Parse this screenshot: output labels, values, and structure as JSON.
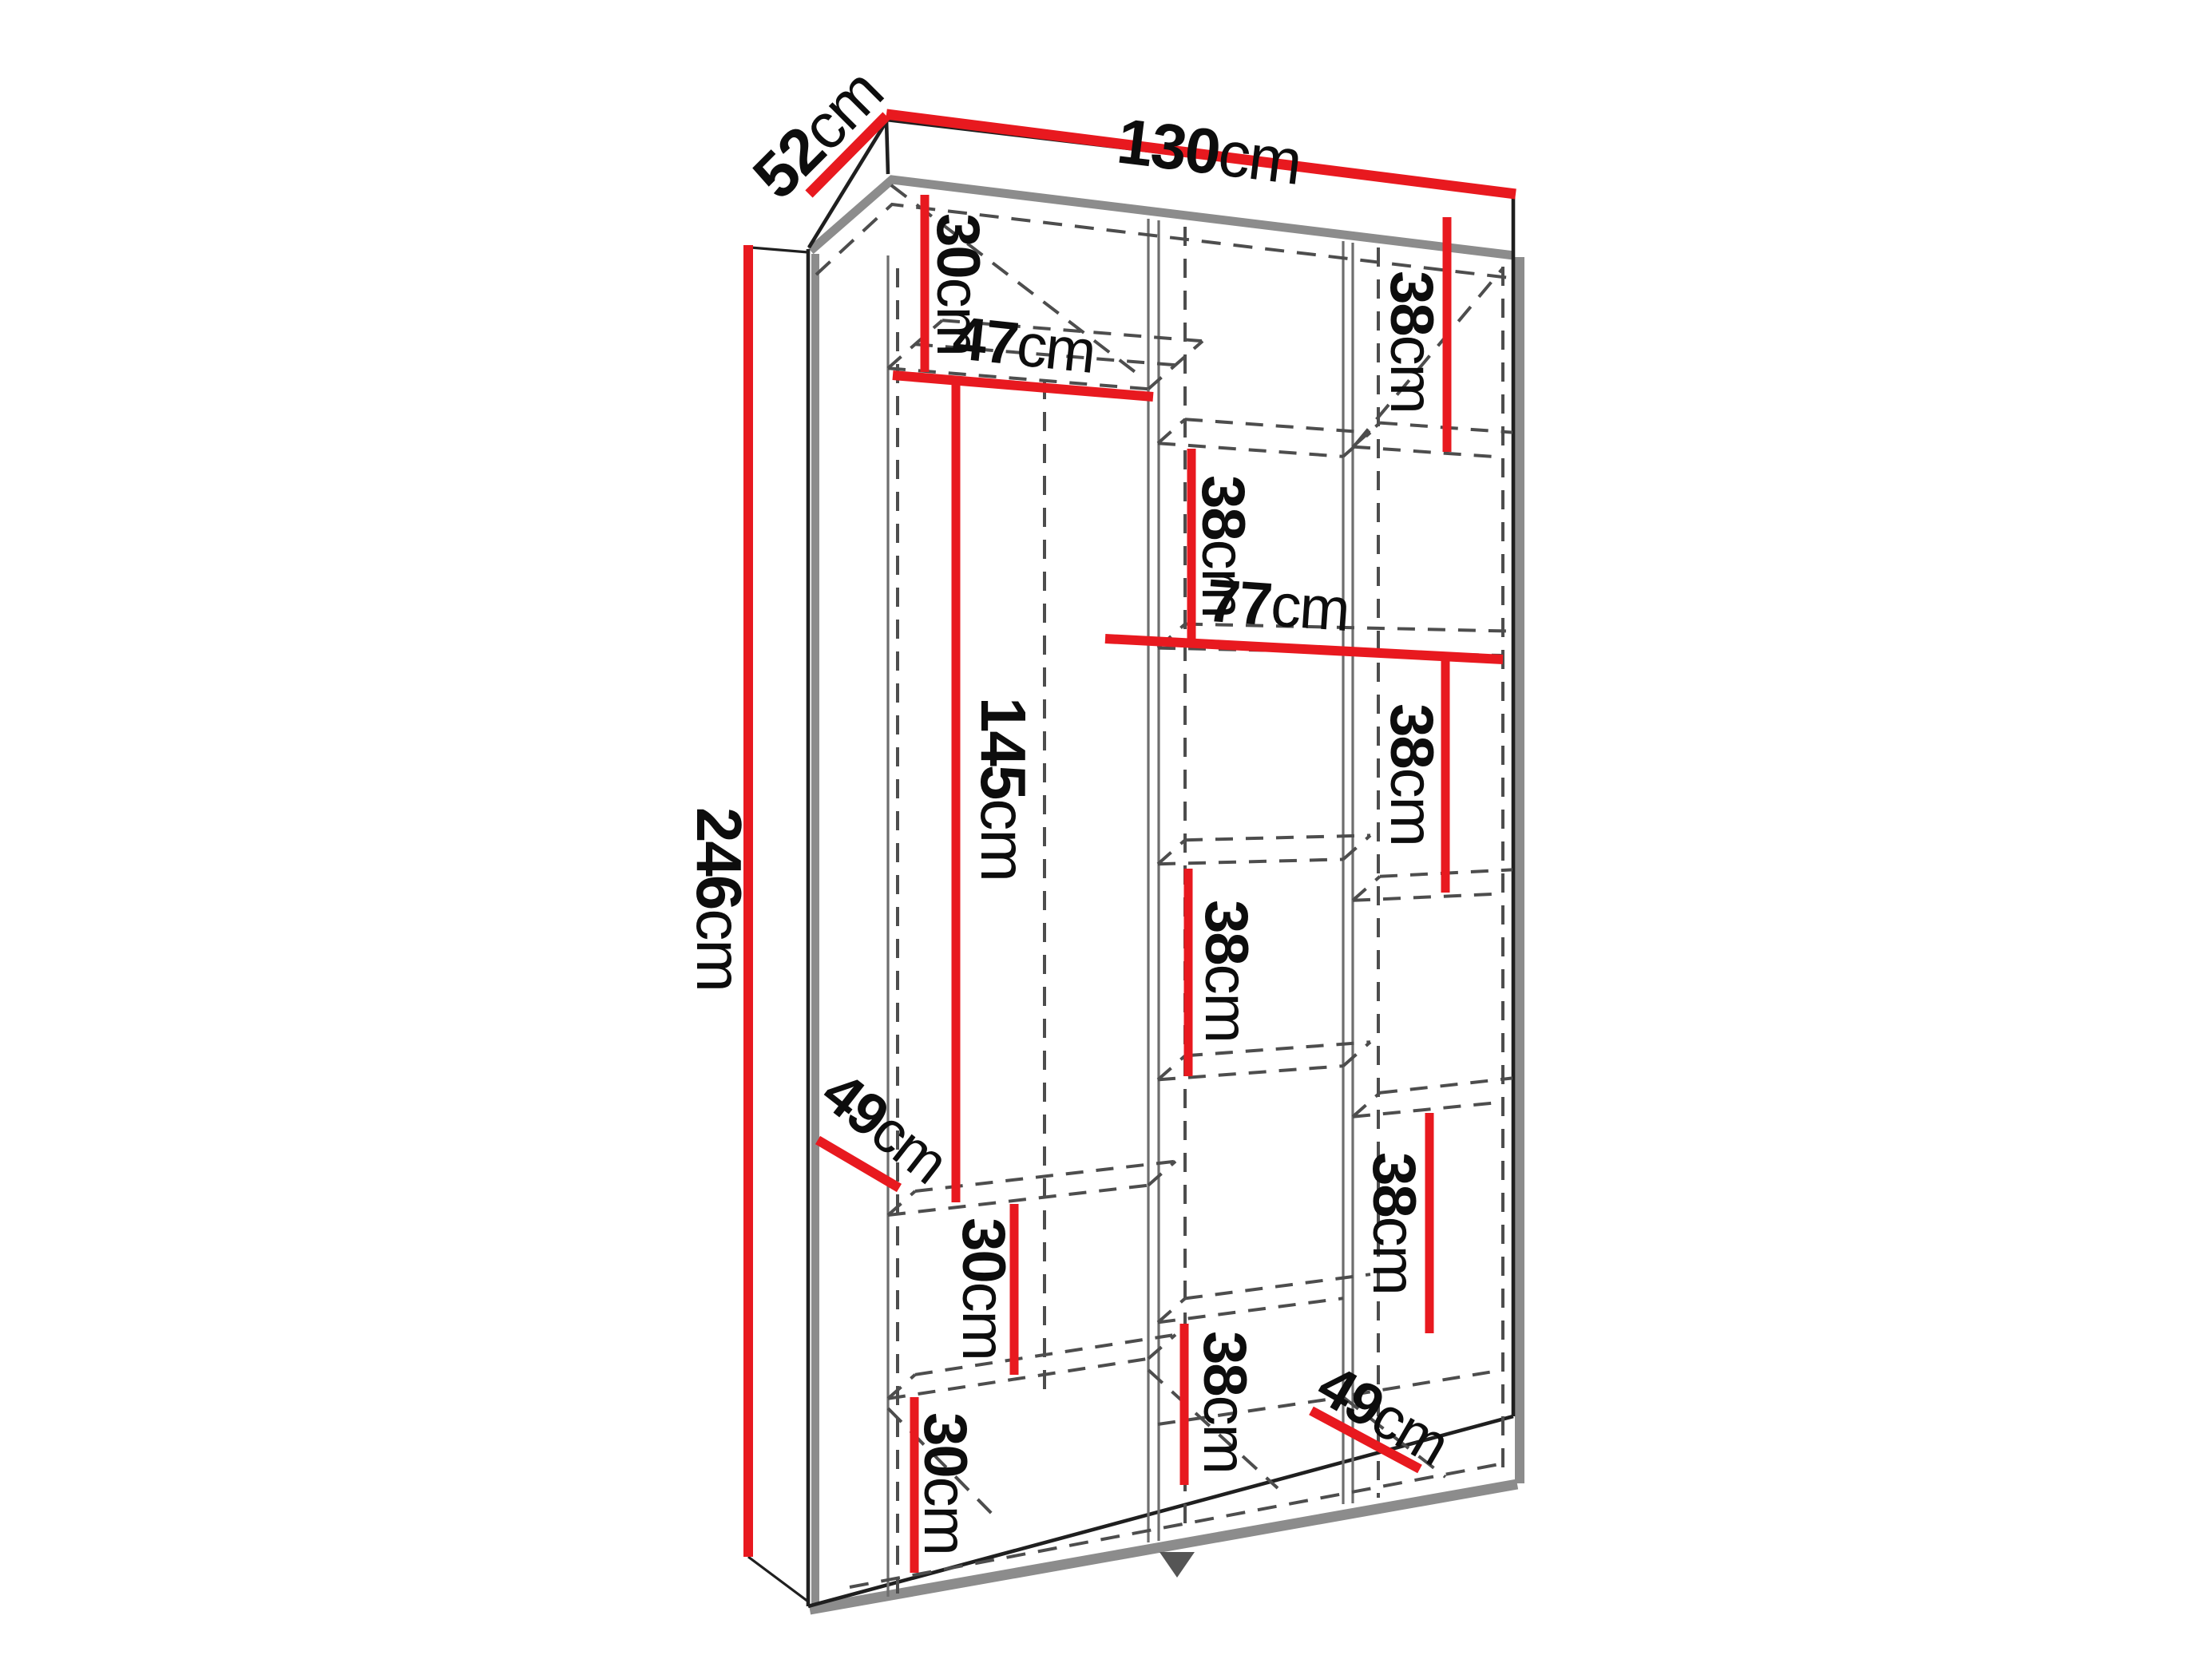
{
  "figure": {
    "kind": "furniture-dimension-diagram",
    "subject": "three-section wardrobe interior with shelf measurements"
  },
  "colors": {
    "dimension_red": "#e8191f",
    "outline_black": "#1f1f1f",
    "shadow_gray": "#8c8c8c",
    "hidden_line_gray": "#4d4d4d",
    "background": "#ffffff"
  },
  "labels": {
    "depth": {
      "num": "52",
      "unit": "cm"
    },
    "width": {
      "num": "130",
      "unit": "cm"
    },
    "height": {
      "num": "246",
      "unit": "cm"
    },
    "top_left_30": {
      "num": "30",
      "unit": "cm"
    },
    "left_shelf_47": {
      "num": "47",
      "unit": "cm"
    },
    "top_right_38": {
      "num": "38",
      "unit": "cm"
    },
    "mid_upper_38": {
      "num": "38",
      "unit": "cm"
    },
    "width_77": {
      "num": "77",
      "unit": "cm"
    },
    "right_mid_38": {
      "num": "38",
      "unit": "cm"
    },
    "mid_lower_38": {
      "num": "38",
      "unit": "cm"
    },
    "hang_145": {
      "num": "145",
      "unit": "cm"
    },
    "left_depth_49": {
      "num": "49",
      "unit": "cm"
    },
    "right_lower_38": {
      "num": "38",
      "unit": "cm"
    },
    "left_mid_30": {
      "num": "30",
      "unit": "cm"
    },
    "left_bottom_30": {
      "num": "30",
      "unit": "cm"
    },
    "mid_bottom_38": {
      "num": "38",
      "unit": "cm"
    },
    "bottom_right_49": {
      "num": "49",
      "unit": "cm"
    }
  }
}
